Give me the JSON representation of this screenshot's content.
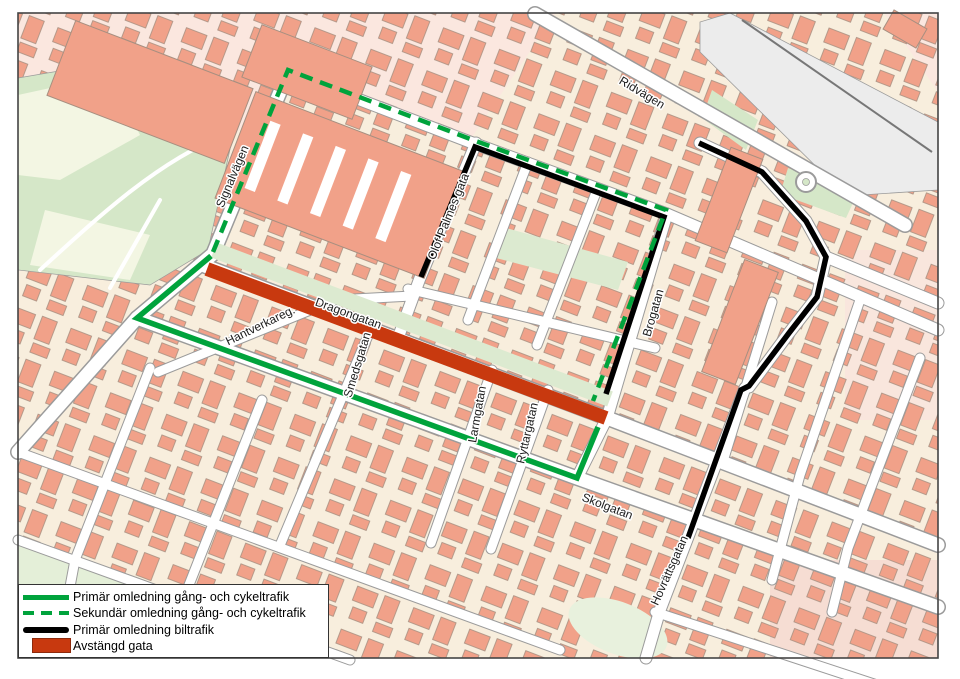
{
  "map": {
    "street_labels": [
      {
        "id": "ridvagen",
        "label": "Ridvägen",
        "x": 640,
        "y": 96,
        "rotation": 31,
        "size": 13
      },
      {
        "id": "signalvagen",
        "label": "Signalvägen",
        "x": 236,
        "y": 178,
        "rotation": -67,
        "size": 12
      },
      {
        "id": "olof-palmes-gata",
        "label": "Olof Palmes gata",
        "x": 452,
        "y": 218,
        "rotation": -68,
        "size": 12
      },
      {
        "id": "dragongatan",
        "label": "Dragongatan",
        "x": 347,
        "y": 317,
        "rotation": 20,
        "size": 13
      },
      {
        "id": "hantverkaregatan",
        "label": "Hantverkareg.",
        "x": 262,
        "y": 329,
        "rotation": -26,
        "size": 12
      },
      {
        "id": "smedsgatan",
        "label": "Smedsgatan",
        "x": 361,
        "y": 366,
        "rotation": -73,
        "size": 12
      },
      {
        "id": "larmgatan",
        "label": "Larmgatan",
        "x": 481,
        "y": 415,
        "rotation": -80,
        "size": 12
      },
      {
        "id": "ryttargatan",
        "label": "Ryttargatan",
        "x": 531,
        "y": 434,
        "rotation": -77,
        "size": 12
      },
      {
        "id": "brogatan",
        "label": "Brogatan",
        "x": 657,
        "y": 314,
        "rotation": -74,
        "size": 12
      },
      {
        "id": "skolgatan",
        "label": "Skolgatan",
        "x": 606,
        "y": 510,
        "rotation": 21,
        "size": 12
      },
      {
        "id": "hovrattsgatan",
        "label": "Hovrättsgatan",
        "x": 673,
        "y": 572,
        "rotation": -66,
        "size": 12
      }
    ],
    "routes": {
      "closed_street": {
        "label": "Avstängd gata",
        "color": "#c8390f",
        "width": 14,
        "segments": [
          [
            [
              207,
              269
            ],
            [
              606,
              418
            ]
          ]
        ]
      },
      "primary_car": {
        "label": "Primär omledning biltrafik",
        "color": "#000000",
        "width": 5.5,
        "segments": [
          [
            [
              421,
              277
            ],
            [
              475,
              147
            ],
            [
              664,
              217
            ],
            [
              606,
              394
            ]
          ],
          [
            [
              699,
              143
            ],
            [
              762,
              172
            ],
            [
              806,
              221
            ],
            [
              826,
              257
            ],
            [
              817,
              297
            ],
            [
              789,
              333
            ],
            [
              749,
              386
            ],
            [
              741,
              390
            ],
            [
              688,
              538
            ]
          ]
        ]
      },
      "primary_bike": {
        "label": "Primär omledning gång- och cykeltrafik",
        "color": "#00a33c",
        "width": 5.5,
        "segments": [
          [
            [
              211,
              256
            ],
            [
              137,
              318
            ],
            [
              577,
              478
            ],
            [
              598,
              427
            ]
          ]
        ]
      },
      "secondary_bike": {
        "label": "Sekundär omledning gång- och cykeltrafik",
        "color": "#00a33c",
        "width": 4.5,
        "dash": "13 8",
        "segments": [
          [
            [
              213,
              252
            ],
            [
              288,
              70
            ],
            [
              473,
              140
            ],
            [
              666,
              210
            ],
            [
              593,
              401
            ]
          ]
        ]
      }
    },
    "legend": {
      "items": [
        {
          "swatch": "solid-green-line",
          "label": "Primär omledning gång- och cykeltrafik"
        },
        {
          "swatch": "dashed-green-line",
          "label": "Sekundär omledning gång- och cykeltrafik"
        },
        {
          "swatch": "solid-black-line",
          "label": "Primär omledning biltrafik"
        },
        {
          "swatch": "red-area",
          "label": "Avstängd gata"
        }
      ]
    },
    "colors": {
      "detour_green": "#00a33c",
      "car_black": "#000000",
      "closed_red": "#c8390f",
      "building_salmon": "#f1a189",
      "block_cream": "#f8eedd",
      "block_pink": "#fbe7df",
      "park_green": "#d5e7c8",
      "railway_gray": "#ececec",
      "road_white": "#ffffff"
    }
  }
}
